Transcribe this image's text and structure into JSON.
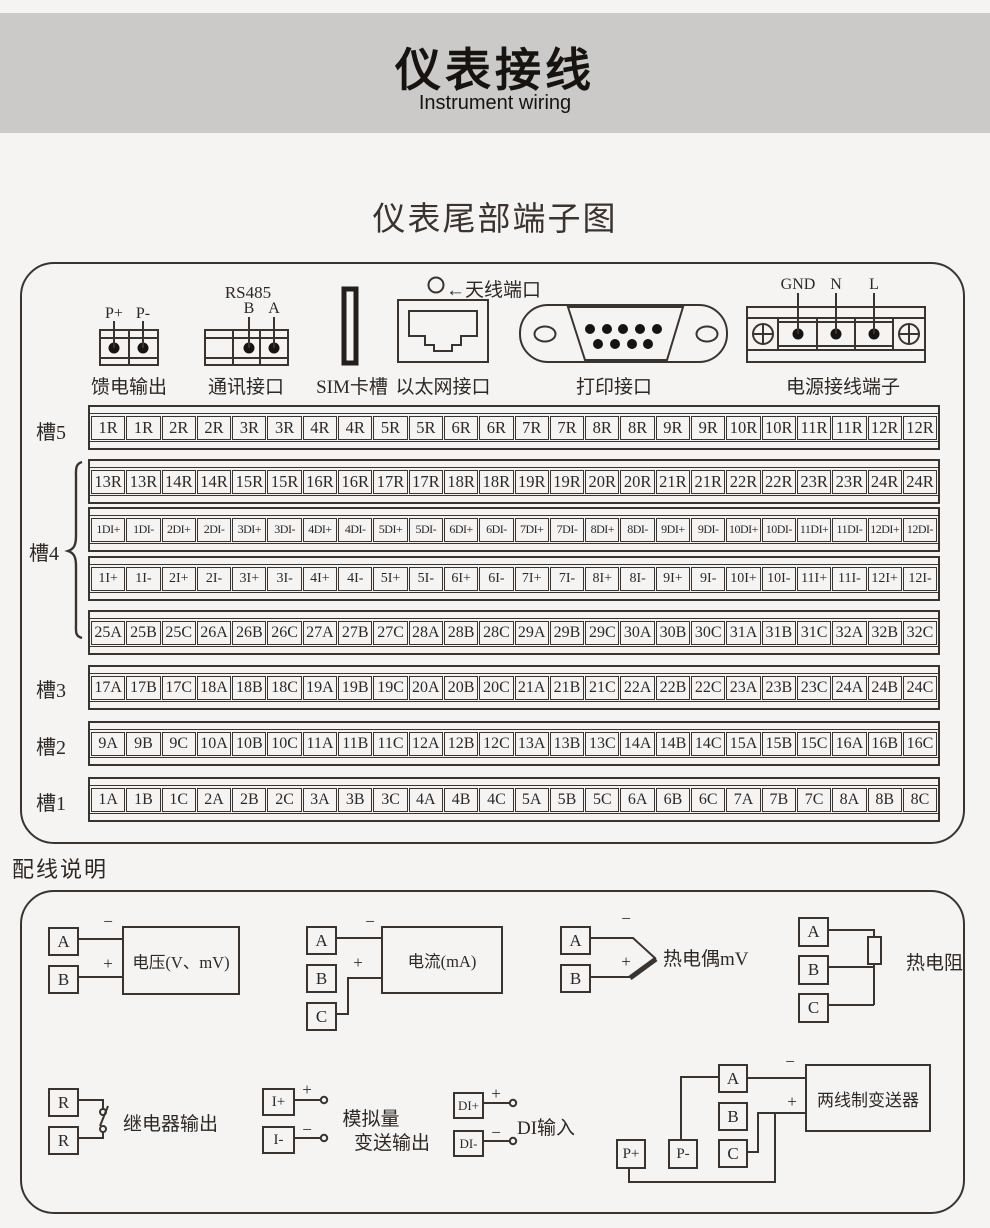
{
  "header": {
    "title": "仪表接线",
    "subtitle": "Instrument wiring"
  },
  "rear_panel": {
    "section_title": "仪表尾部端子图",
    "feed_output": {
      "caption": "馈电输出",
      "pin_plus": "P+",
      "pin_minus": "P-"
    },
    "comm_port": {
      "caption": "通讯接口",
      "protocol": "RS485",
      "pin_b": "B",
      "pin_a": "A"
    },
    "sim_slot": {
      "caption": "SIM卡槽"
    },
    "ethernet": {
      "caption": "以太网接口"
    },
    "antenna": {
      "caption": "←天线端口"
    },
    "print_port": {
      "caption": "打印接口"
    },
    "power_terminal": {
      "caption": "电源接线端子",
      "pin_gnd": "GND",
      "pin_n": "N",
      "pin_l": "L"
    },
    "slots": [
      {
        "label": "槽5",
        "rows": [
          [
            "1R",
            "1R",
            "2R",
            "2R",
            "3R",
            "3R",
            "4R",
            "4R",
            "5R",
            "5R",
            "6R",
            "6R",
            "7R",
            "7R",
            "8R",
            "8R",
            "9R",
            "9R",
            "10R",
            "10R",
            "11R",
            "11R",
            "12R",
            "12R"
          ]
        ]
      },
      {
        "label": "槽4",
        "rows": [
          [
            "13R",
            "13R",
            "14R",
            "14R",
            "15R",
            "15R",
            "16R",
            "16R",
            "17R",
            "17R",
            "18R",
            "18R",
            "19R",
            "19R",
            "20R",
            "20R",
            "21R",
            "21R",
            "22R",
            "22R",
            "23R",
            "23R",
            "24R",
            "24R"
          ],
          [
            "1DI+",
            "1DI-",
            "2DI+",
            "2DI-",
            "3DI+",
            "3DI-",
            "4DI+",
            "4DI-",
            "5DI+",
            "5DI-",
            "6DI+",
            "6DI-",
            "7DI+",
            "7DI-",
            "8DI+",
            "8DI-",
            "9DI+",
            "9DI-",
            "10DI+",
            "10DI-",
            "11DI+",
            "11DI-",
            "12DI+",
            "12DI-"
          ],
          [
            "1I+",
            "1I-",
            "2I+",
            "2I-",
            "3I+",
            "3I-",
            "4I+",
            "4I-",
            "5I+",
            "5I-",
            "6I+",
            "6I-",
            "7I+",
            "7I-",
            "8I+",
            "8I-",
            "9I+",
            "9I-",
            "10I+",
            "10I-",
            "11I+",
            "11I-",
            "12I+",
            "12I-"
          ],
          [
            "25A",
            "25B",
            "25C",
            "26A",
            "26B",
            "26C",
            "27A",
            "27B",
            "27C",
            "28A",
            "28B",
            "28C",
            "29A",
            "29B",
            "29C",
            "30A",
            "30B",
            "30C",
            "31A",
            "31B",
            "31C",
            "32A",
            "32B",
            "32C"
          ]
        ]
      },
      {
        "label": "槽3",
        "rows": [
          [
            "17A",
            "17B",
            "17C",
            "18A",
            "18B",
            "18C",
            "19A",
            "19B",
            "19C",
            "20A",
            "20B",
            "20C",
            "21A",
            "21B",
            "21C",
            "22A",
            "22B",
            "22C",
            "23A",
            "23B",
            "23C",
            "24A",
            "24B",
            "24C"
          ]
        ]
      },
      {
        "label": "槽2",
        "rows": [
          [
            "9A",
            "9B",
            "9C",
            "10A",
            "10B",
            "10C",
            "11A",
            "11B",
            "11C",
            "12A",
            "12B",
            "12C",
            "13A",
            "13B",
            "13C",
            "14A",
            "14B",
            "14C",
            "15A",
            "15B",
            "15C",
            "16A",
            "16B",
            "16C"
          ]
        ]
      },
      {
        "label": "槽1",
        "rows": [
          [
            "1A",
            "1B",
            "1C",
            "2A",
            "2B",
            "2C",
            "3A",
            "3B",
            "3C",
            "4A",
            "4B",
            "4C",
            "5A",
            "5B",
            "5C",
            "6A",
            "6B",
            "6C",
            "7A",
            "7B",
            "7C",
            "8A",
            "8B",
            "8C"
          ]
        ]
      }
    ]
  },
  "wiring": {
    "section_title": "配线说明",
    "plus": "+",
    "minus": "−",
    "voltage": {
      "t1": "A",
      "t2": "B",
      "device": "电压(V、mV)"
    },
    "current": {
      "t1": "A",
      "t2": "B",
      "t3": "C",
      "device": "电流(mA)"
    },
    "thermocouple": {
      "t1": "A",
      "t2": "B",
      "label": "热电偶mV"
    },
    "rtd": {
      "t1": "A",
      "t2": "B",
      "t3": "C",
      "label": "热电阻"
    },
    "relay": {
      "t1": "R",
      "t2": "R",
      "label": "继电器输出"
    },
    "analog_out": {
      "t1": "I+",
      "t2": "I-",
      "label1": "模拟量",
      "label2": "变送输出"
    },
    "di_input": {
      "t1": "DI+",
      "t2": "DI-",
      "label": "DI输入"
    },
    "transmitter": {
      "t1": "A",
      "t2": "B",
      "t3": "C",
      "p_plus": "P+",
      "p_minus": "P-",
      "device": "两线制变送器"
    }
  }
}
